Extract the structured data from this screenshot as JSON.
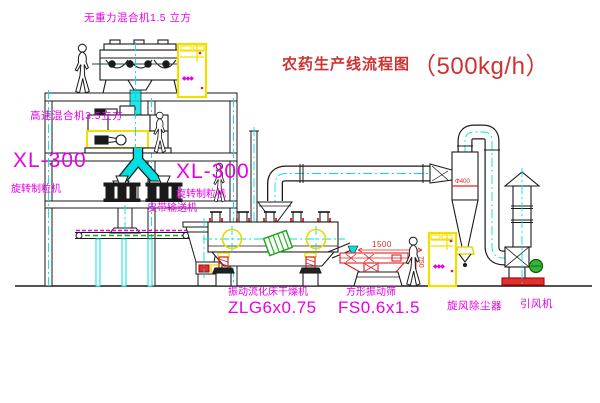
{
  "title": {
    "name": "农药生产线流程图",
    "capacity": "（500kg/h）"
  },
  "labels": {
    "gravity_mixer": "无重力混合机1.5 立方",
    "high_speed_mixer": "高速混合机3.5立方",
    "granulator_left_model": "XL-300",
    "granulator_left_name": "旋转制粒机",
    "granulator_center_model": "XL-300",
    "granulator_center_name": "旋转制粒机",
    "belt_conveyor": "皮带输送机",
    "dryer_name": "振动流化床干燥机",
    "dryer_model": "ZLG6x0.75",
    "sifter_name": "方形振动筛",
    "sifter_model": "FS0.6x1.5",
    "cyclone": "旋风除尘器",
    "fan": "引风机"
  },
  "dimensions": {
    "sifter_length": "1500",
    "sifter_height": "750",
    "cyclone_note": "Φ400"
  },
  "cabinets": {
    "indicator": "◆◆◆"
  },
  "colors": {
    "line_black": "#1a1a1a",
    "label_magenta": "#e800e8",
    "title_red": "#cf3232",
    "detail_red": "#e02020",
    "cabinet_yellow": "#f0e000",
    "pipe_cyan": "#00e0e0",
    "motor_green": "#35b535"
  }
}
